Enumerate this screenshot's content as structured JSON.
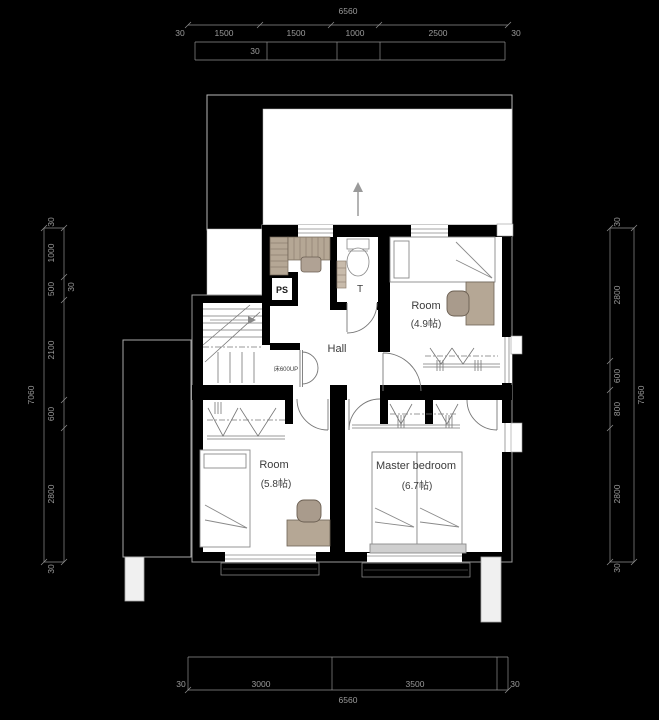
{
  "drawing": {
    "rooms": {
      "hall": "Hall",
      "toilet": "T",
      "pipe_space": "PS",
      "stair_note": "床600UP",
      "room_a_name": "Room",
      "room_a_size": "(4.9帖)",
      "room_b_name": "Room",
      "room_b_size": "(5.8帖)",
      "master_name": "Master bedroom",
      "master_size": "(6.7帖)"
    },
    "dims": {
      "top_total": "6560",
      "top": [
        "30",
        "1500",
        "1500",
        "1000",
        "2500",
        "30"
      ],
      "top_sub": "30",
      "bottom": [
        "30",
        "3000",
        "3500",
        "30"
      ],
      "bottom_total": "6560",
      "left_total": "7060",
      "left": [
        "30",
        "1000",
        "500",
        "2100",
        "600",
        "2800",
        "30"
      ],
      "left_sub": "30",
      "right_total": "7060",
      "right": [
        "30",
        "2800",
        "600",
        "800",
        "2800",
        "30"
      ]
    },
    "colors": {
      "background": "#000000",
      "room_fill": "#ffffff",
      "wall": "#000000",
      "wood": "#b5a795",
      "dim": "#9b9b9b",
      "headboard": "#cfcfcf"
    }
  }
}
